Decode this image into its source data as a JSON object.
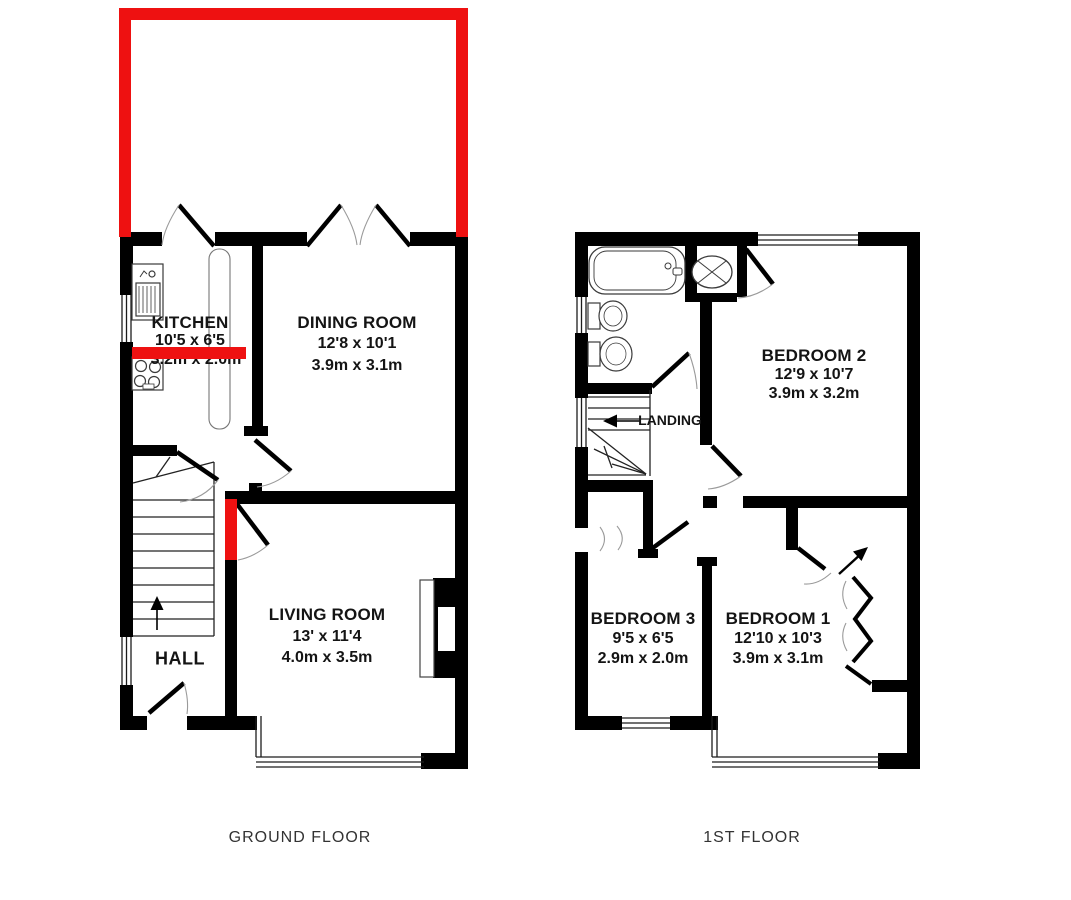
{
  "palette": {
    "wall": "#000000",
    "thin_line": "#1c1c1c",
    "arc": "#9a9a9a",
    "fixture": "#3a3a3a",
    "red": "#ee1111",
    "background": "#ffffff"
  },
  "ground_floor": {
    "label": "GROUND FLOOR",
    "rooms": {
      "kitchen": {
        "name": "KITCHEN",
        "imperial": "10'5 x 6'5",
        "metric": "3.2m x 2.0m"
      },
      "dining": {
        "name": "DINING ROOM",
        "imperial": "12'8 x 10'1",
        "metric": "3.9m x 3.1m"
      },
      "living": {
        "name": "LIVING ROOM",
        "imperial": "13' x 11'4",
        "metric": "4.0m x 3.5m"
      },
      "hall": {
        "name": "HALL"
      }
    }
  },
  "first_floor": {
    "label": "1ST FLOOR",
    "rooms": {
      "bedroom2": {
        "name": "BEDROOM 2",
        "imperial": "12'9 x 10'7",
        "metric": "3.9m x 3.2m"
      },
      "bedroom3": {
        "name": "BEDROOM 3",
        "imperial": "9'5 x 6'5",
        "metric": "2.9m x 2.0m"
      },
      "bedroom1": {
        "name": "BEDROOM 1",
        "imperial": "12'10 x 10'3",
        "metric": "3.9m x 3.1m"
      },
      "landing": {
        "name": "LANDING"
      }
    }
  }
}
